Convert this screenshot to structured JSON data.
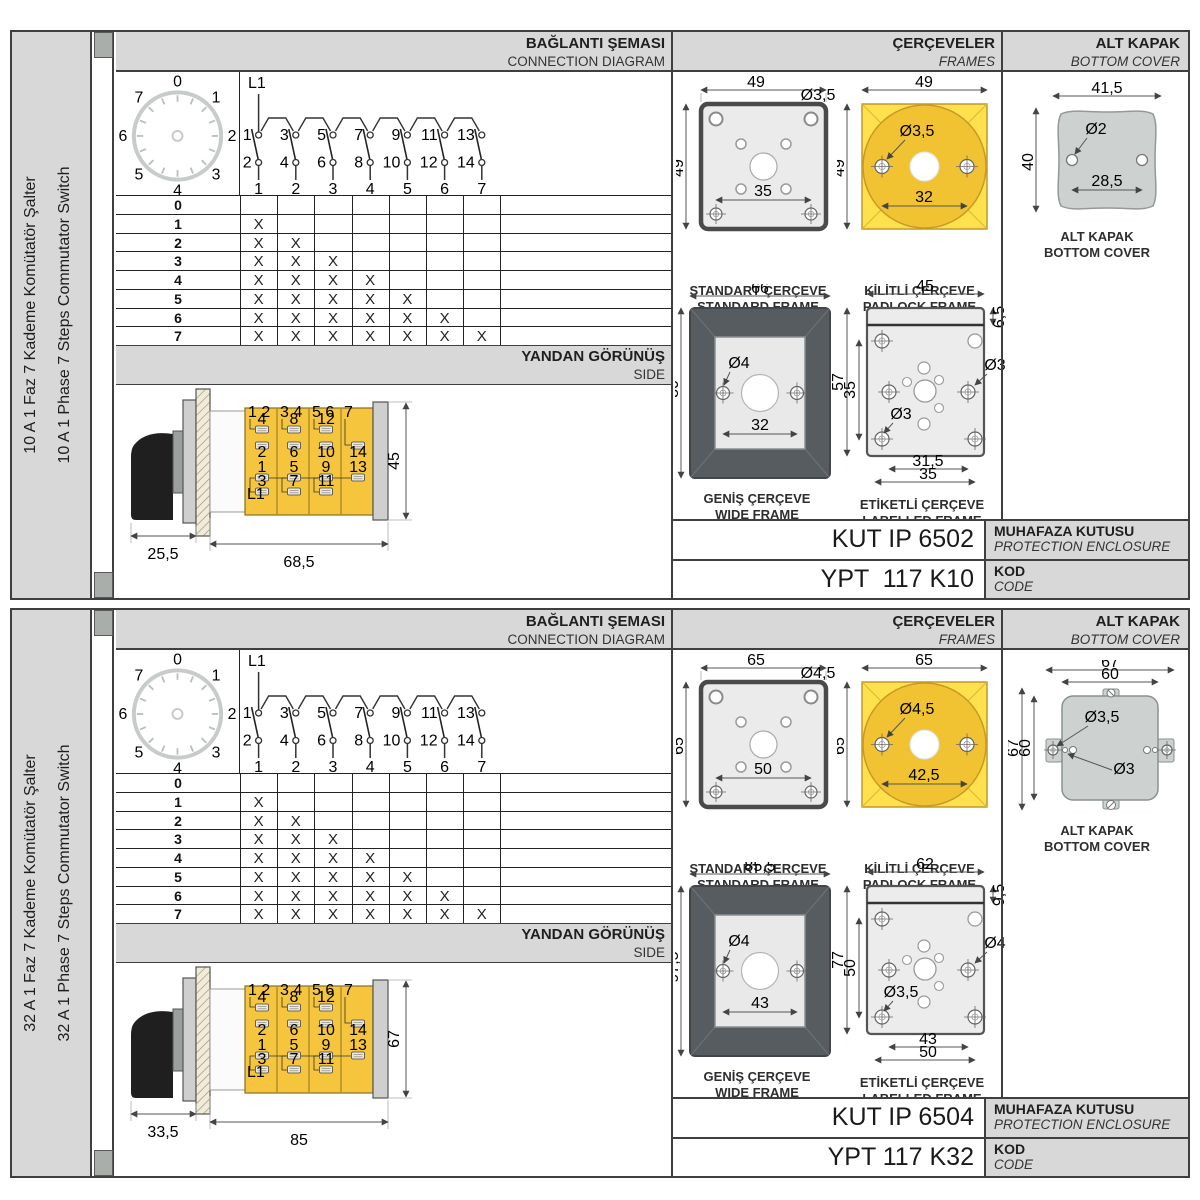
{
  "shared": {
    "headers": {
      "connection_tr": "BAĞLANTI ŞEMASI",
      "connection_en": "CONNECTION DIAGRAM",
      "frames_tr": "ÇERÇEVELER",
      "frames_en": "FRAMES",
      "cover_tr": "ALT KAPAK",
      "cover_en": "BOTTOM COVER",
      "side_tr": "YANDAN GÖRÜNÜŞ",
      "side_en": "SIDE",
      "enclosure_tr": "MUHAFAZA KUTUSU",
      "enclosure_en": "PROTECTION ENCLOSURE",
      "code_tr": "KOD",
      "code_en": "CODE"
    },
    "captions": {
      "standard_tr": "STANDART ÇERÇEVE",
      "standard_en": "STANDARD FRAME",
      "padlock_tr": "KİLİTLİ ÇERÇEVE",
      "padlock_en": "PADLOCK FRAME",
      "wide_tr": "GENİŞ ÇERÇEVE",
      "wide_en": "WIDE FRAME",
      "labelled_tr": "ETİKETLİ ÇERÇEVE",
      "labelled_en": "LABELLED FRAME",
      "cover_tr": "ALT KAPAK",
      "cover_en": "BOTTOM COVER"
    },
    "dial": {
      "numbers": [
        "0",
        "1",
        "2",
        "3",
        "4",
        "5",
        "6",
        "7"
      ]
    },
    "circuit": {
      "source": "L1",
      "top_contacts": [
        "1",
        "3",
        "5",
        "7",
        "9",
        "11",
        "13"
      ],
      "bottom_contacts": [
        "2",
        "4",
        "6",
        "8",
        "10",
        "12",
        "14"
      ],
      "terminals": [
        "1",
        "2",
        "3",
        "4",
        "5",
        "6",
        "7"
      ]
    },
    "step_table": {
      "rows": [
        {
          "label": "0",
          "cells": [
            "",
            "",
            "",
            "",
            "",
            "",
            ""
          ]
        },
        {
          "label": "1",
          "cells": [
            "X",
            "",
            "",
            "",
            "",
            "",
            ""
          ]
        },
        {
          "label": "2",
          "cells": [
            "X",
            "X",
            "",
            "",
            "",
            "",
            ""
          ]
        },
        {
          "label": "3",
          "cells": [
            "X",
            "X",
            "X",
            "",
            "",
            "",
            ""
          ]
        },
        {
          "label": "4",
          "cells": [
            "X",
            "X",
            "X",
            "X",
            "",
            "",
            ""
          ]
        },
        {
          "label": "5",
          "cells": [
            "X",
            "X",
            "X",
            "X",
            "X",
            "",
            ""
          ]
        },
        {
          "label": "6",
          "cells": [
            "X",
            "X",
            "X",
            "X",
            "X",
            "X",
            ""
          ]
        },
        {
          "label": "7",
          "cells": [
            "X",
            "X",
            "X",
            "X",
            "X",
            "X",
            "X"
          ]
        }
      ]
    },
    "side_cells": [
      {
        "corner": "1 2",
        "u1": "4",
        "u2": "2",
        "l1": "1",
        "l2": "3",
        "tag": "L1"
      },
      {
        "corner": "3 4",
        "u1": "8",
        "u2": "6",
        "l1": "5",
        "l2": "7",
        "tag": ""
      },
      {
        "corner": "5 6",
        "u1": "12",
        "u2": "10",
        "l1": "9",
        "l2": "11",
        "tag": ""
      },
      {
        "corner": "7",
        "u1": "14",
        "u2": "",
        "l1": "13",
        "l2": "",
        "tag": ""
      }
    ],
    "colors": {
      "band_gray": "#d8d8d8",
      "border_dark": "#3f3f3f",
      "yellow_bright": "#ffe14d",
      "yellow_mid": "#f1c232",
      "body_yellow": "#f4c53d",
      "frame_dark": "#575c60",
      "metal_light": "#ebebeb",
      "cover_gray": "#cdd2d0",
      "contact_gray": "#9a9a9a"
    }
  },
  "sections": [
    {
      "sidebar_tr": "10 A 1 Faz 7 Kademe Komütatör Şalter",
      "sidebar_en": "10 A 1 Phase 7 Steps Commutator Switch",
      "side_view": {
        "front": "25,5",
        "body": "68,5",
        "height": "45"
      },
      "frames": {
        "standard": {
          "w": "49",
          "h": "49",
          "hole": "Ø3,5",
          "inner": "35"
        },
        "padlock": {
          "w": "49",
          "h": "49",
          "hole": "Ø3,5",
          "inner": "32"
        },
        "wide": {
          "w": "66",
          "h": "80",
          "hole": "Ø4",
          "inner": "32"
        },
        "labelled": {
          "w": "45",
          "band": "6,5",
          "h": "57",
          "inner_h": "35",
          "hole_right": "Ø3",
          "hole_left": "Ø3",
          "dim_a": "31,5",
          "dim_b": "35"
        }
      },
      "cover": {
        "style": "plain",
        "dims": {
          "top": "41,5",
          "left": "40",
          "hole": "Ø2",
          "inner": "28,5"
        }
      },
      "codes": {
        "enclosure": "KUT IP 6502",
        "code": "YPT  117 K10"
      }
    },
    {
      "sidebar_tr": "32 A 1 Faz 7 Kademe Komütatör Şalter",
      "sidebar_en": "32 A 1 Phase 7 Steps Commutator Switch",
      "side_view": {
        "front": "33,5",
        "body": "85",
        "height": "67"
      },
      "frames": {
        "standard": {
          "w": "65",
          "h": "65",
          "hole": "Ø4,5",
          "inner": "50"
        },
        "padlock": {
          "w": "65",
          "h": "65",
          "hole": "Ø4,5",
          "inner": "42,5"
        },
        "wide": {
          "w": "85,5",
          "h": "97,5",
          "hole": "Ø4",
          "inner": "43"
        },
        "labelled": {
          "w": "62",
          "band": "9,5",
          "h": "77",
          "inner_h": "50",
          "hole_right": "Ø4",
          "hole_left": "Ø3,5",
          "dim_a": "43",
          "dim_b": "50"
        }
      },
      "cover": {
        "style": "tabs",
        "dims": {
          "top_outer": "67",
          "top_inner": "60",
          "left_outer": "67",
          "left_inner": "60",
          "hole_a": "Ø3,5",
          "hole_b": "Ø3"
        }
      },
      "codes": {
        "enclosure": "KUT IP 6504",
        "code": "YPT 117 K32"
      }
    }
  ]
}
